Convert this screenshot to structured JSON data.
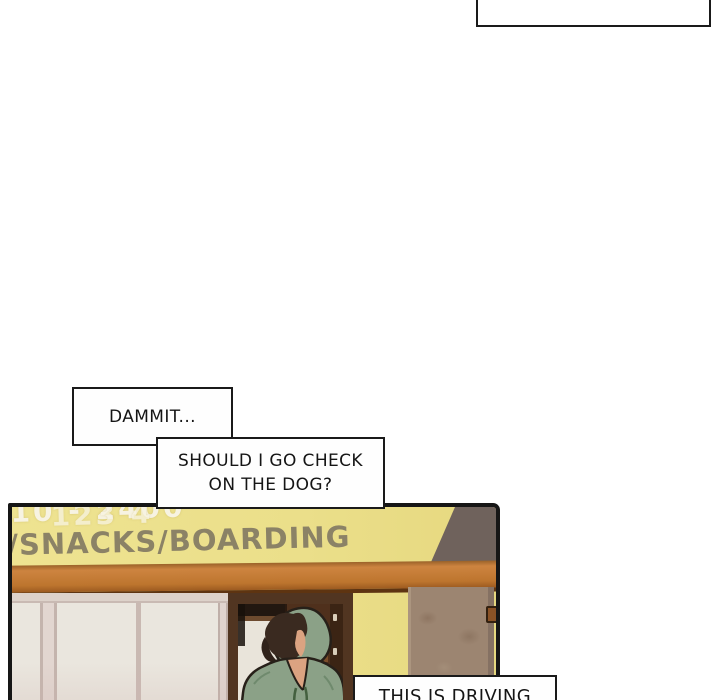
{
  "scene_type": "webtoon-comic-page",
  "caption_box_top_right": {
    "text": ""
  },
  "bubbles": {
    "dammit": {
      "text": "DAMMIT..."
    },
    "check_dog": {
      "line1": "SHOULD I GO CHECK",
      "line2": "ON THE DOG?"
    },
    "driving": {
      "text": "THIS IS DRIVING"
    }
  },
  "panel": {
    "sign": {
      "phone_left": "10 - 2400",
      "phone_right": "123 4",
      "services": "/SNACKS/BOARDING"
    },
    "colors": {
      "wall_yellow": "#ebdf8a",
      "upper_wall_gray": "#6f625c",
      "beam_brown": "#bd752e",
      "stone_pillar": "#9c8571",
      "window_panel": "#eae6de",
      "door_brown": "#4f301c",
      "hoodie_green": "#8ba187",
      "hair_brown": "#3a2a20",
      "skin": "#dba381",
      "sign_text": "#8b8266",
      "outline": "#161616"
    }
  }
}
